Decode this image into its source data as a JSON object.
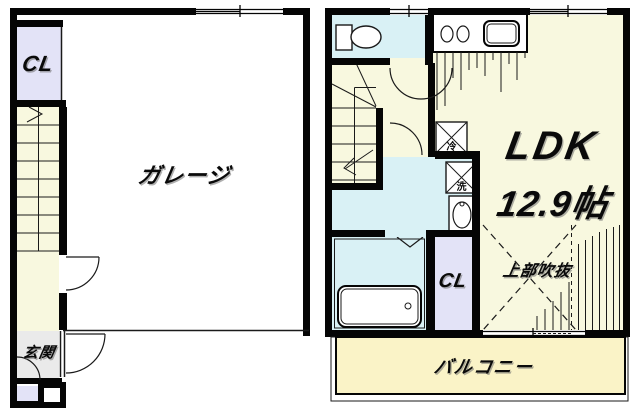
{
  "floor1": {
    "closet_label": "CL",
    "garage_label": "ガレージ",
    "entrance_label": "玄関"
  },
  "floor2": {
    "ldk_label": "LDK",
    "ldk_size_label": "12.9帖",
    "closet_label": "CL",
    "void_label": "上部吹抜",
    "balcony_label": "バルコニー",
    "fridge_label": "冷",
    "washer_label": "洗"
  },
  "colors": {
    "wall_black": "#050505",
    "room_cream": "#F8F8DF",
    "room_cyan": "#D9F1F5",
    "room_lavender": "#E3E3F7",
    "entrance_gray": "#EAEAEA",
    "balcony_yellow": "#FAF3C7",
    "garage_white": "#FFFFFF"
  }
}
